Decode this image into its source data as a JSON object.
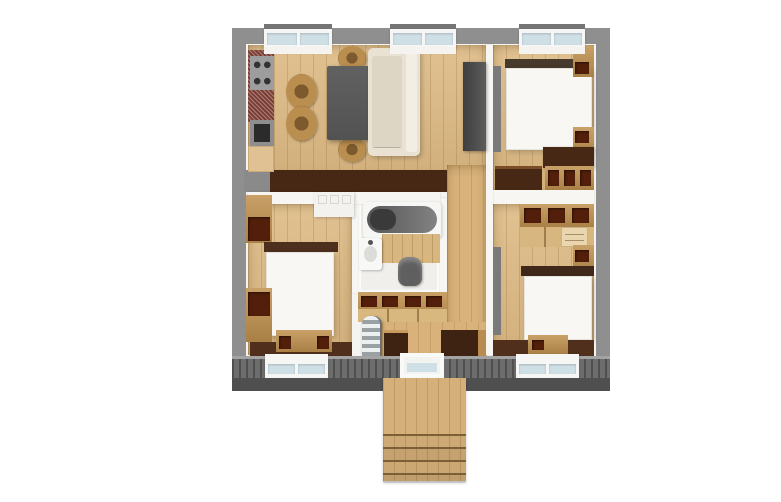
{
  "scene": {
    "label": "Apartment floor plan - top-down 3D render",
    "style": "photoreal render, no text labels"
  },
  "colors": {
    "canvas-bg": "#ffffff",
    "wall-gray": "#8f8f8f",
    "wall-gray-striped": "#6d6d6d",
    "fascia-gray": "#4f4f4f",
    "inner-wall-white": "#f5f4f0",
    "floor-wood": "#ddba84",
    "corridor-wood": "#d8b27a",
    "bathroom-white": "#f0efeb",
    "dark-brown": "#462815",
    "mid-wood": "#c0914e",
    "light-wood": "#e0c194",
    "bed-white": "#f8f7f4",
    "sofa-cream": "#e9e2d3",
    "dark-gray": "#555555",
    "glass-blue": "#cfdfe6",
    "counter-red": "#8e4a40",
    "stove-gray": "#9d9d9d"
  },
  "rooms": {
    "living": {
      "label": "Living / dining room with kitchen"
    },
    "bedroom_tr": {
      "label": "Bedroom (top right)"
    },
    "bedroom_bl": {
      "label": "Bedroom (bottom left)"
    },
    "bedroom_br": {
      "label": "Bedroom (bottom right)"
    },
    "bathroom": {
      "label": "Bathroom"
    },
    "hallway": {
      "label": "Hallway"
    },
    "entry": {
      "label": "Entrance hall"
    }
  },
  "furniture": {
    "kitchen_counter": {
      "label": "Kitchen counter"
    },
    "stove": {
      "label": "Stove with 4 burners"
    },
    "kitchen_sink": {
      "label": "Kitchen sink"
    },
    "dining_table": {
      "label": "Dining table"
    },
    "chair": {
      "label": "Dining chair"
    },
    "sofa": {
      "label": "Sofa"
    },
    "tv_unit": {
      "label": "TV cabinet"
    },
    "bed": {
      "label": "Double bed"
    },
    "nightstand": {
      "label": "Nightstand"
    },
    "wardrobe": {
      "label": "Wardrobe"
    },
    "desk": {
      "label": "Desk with shelves"
    },
    "dresser": {
      "label": "Dresser"
    },
    "bench": {
      "label": "Bench"
    },
    "bathtub": {
      "label": "Bathtub"
    },
    "washbasin": {
      "label": "Washbasin"
    },
    "toilet": {
      "label": "Toilet"
    },
    "vanity": {
      "label": "Bathroom vanity"
    },
    "hall_wardrobe": {
      "label": "Hall wardrobe"
    },
    "stairs_interior": {
      "label": "Interior staircase"
    },
    "stairs_exterior": {
      "label": "Exterior entrance stairs"
    },
    "entry_door": {
      "label": "Entrance door"
    },
    "window": {
      "label": "Window"
    }
  }
}
